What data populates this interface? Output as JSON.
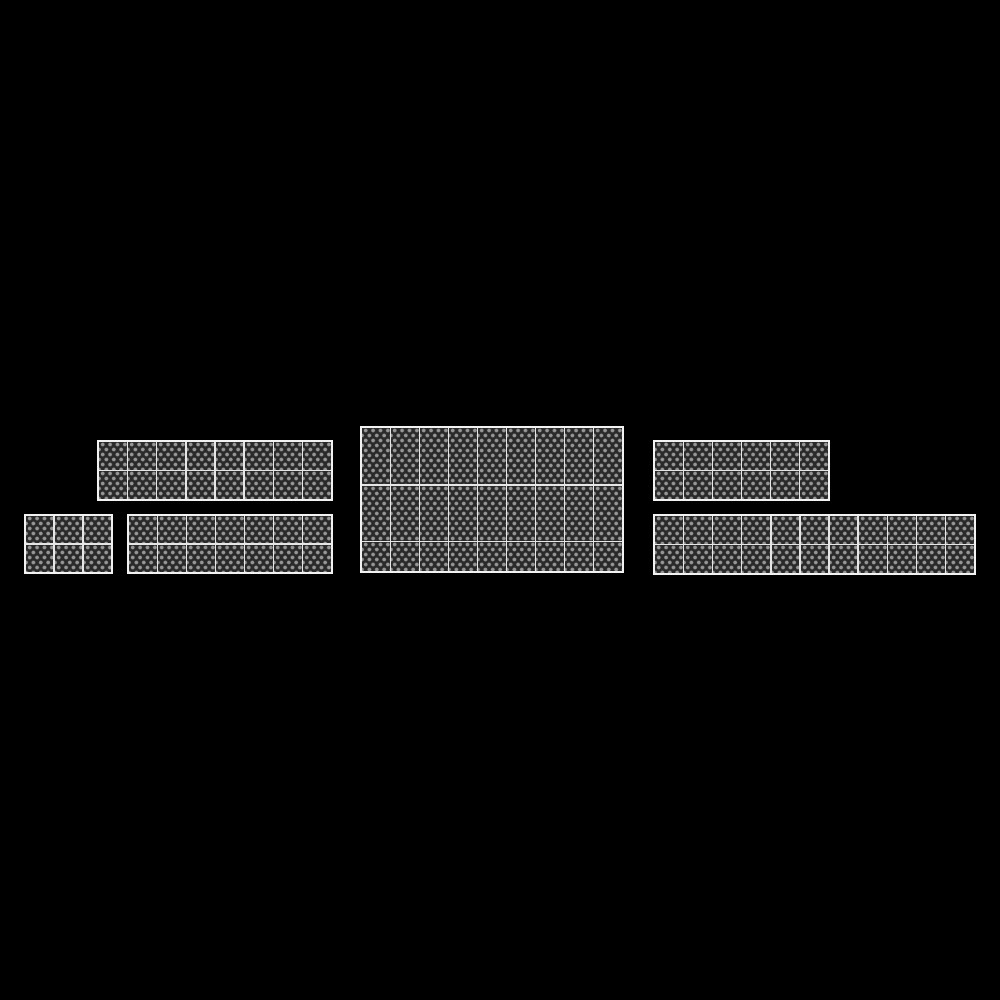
{
  "scene": {
    "description": "Solar panel array layout on black canvas",
    "canvas_width": 1000,
    "canvas_height": 1000,
    "background_color": "#000000"
  },
  "panel_style": {
    "fill_color": "#2a2a2a",
    "dot_color": "#969696",
    "inner_line_color": "#e6e6e6",
    "outer_line_color": "#f2f2f2",
    "dot_spacing_x_px": 7.4,
    "dot_row_spacing_px": 5,
    "dot_diameter_px": 3
  },
  "arrays": [
    {
      "id": "array-1",
      "label": "8 x 2 array",
      "x": 97,
      "y": 440,
      "width": 236,
      "height": 61,
      "cols": 8,
      "row_heights": [
        29,
        29
      ],
      "panel_count": 16
    },
    {
      "id": "array-2",
      "label": "3 x 2 array",
      "x": 24,
      "y": 514,
      "width": 89,
      "height": 60,
      "cols": 3,
      "row_heights": [
        29,
        29
      ],
      "panel_count": 6
    },
    {
      "id": "array-3",
      "label": "7 x 2 array",
      "x": 127,
      "y": 514,
      "width": 206,
      "height": 60,
      "cols": 7,
      "row_heights": [
        29,
        29
      ],
      "panel_count": 14
    },
    {
      "id": "array-4",
      "label": "9 x 3 array",
      "x": 360,
      "y": 426,
      "width": 264,
      "height": 147,
      "cols": 9,
      "row_heights": [
        59,
        58,
        30
      ],
      "panel_count": 27
    },
    {
      "id": "array-5",
      "label": "6 x 2 array",
      "x": 653,
      "y": 440,
      "width": 177,
      "height": 61,
      "cols": 6,
      "row_heights": [
        29,
        29
      ],
      "panel_count": 12
    },
    {
      "id": "array-6",
      "label": "11 x 2 array",
      "x": 653,
      "y": 514,
      "width": 323,
      "height": 61,
      "cols": 11,
      "row_heights": [
        29,
        29
      ],
      "panel_count": 22
    }
  ],
  "totals": {
    "array_count": 6,
    "panel_count": 97
  }
}
